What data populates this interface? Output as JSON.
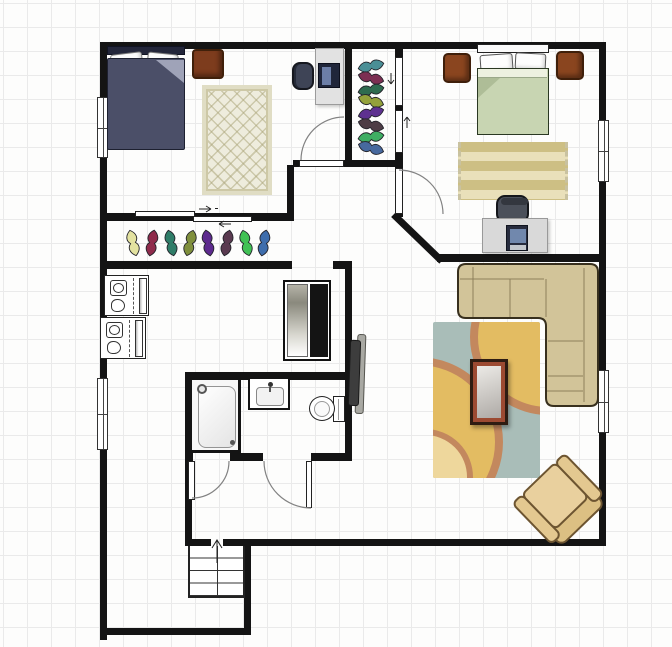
{
  "plan": {
    "width": 672,
    "height": 647,
    "grid_size": 24,
    "palette": {
      "background": "#fdfdfc",
      "grid_line": "#eaeaea",
      "wall": "#141414",
      "door_arc": "#828282",
      "bed1_blanket": "#4b4f68",
      "bed2_blanket": "#c8d5b2",
      "wood_furniture": "#7d3c1d",
      "sofa": "#d2c499",
      "armchair": "#e9d09e",
      "living_rug_base": "#a9bdb8",
      "living_rug_circle": "#e3bc62",
      "living_rug_ring": "#c3885e",
      "bed2_rug_stripe_dark": "#cdbf84",
      "bed2_rug_stripe_light": "#e9e0ba"
    }
  },
  "walls": [
    {
      "name": "wall-exterior-top",
      "rect": [
        100,
        42,
        506,
        7
      ]
    },
    {
      "name": "wall-exterior-left",
      "rect": [
        100,
        42,
        7,
        598
      ]
    },
    {
      "name": "wall-exterior-right",
      "rect": [
        599,
        42,
        7,
        504
      ]
    },
    {
      "name": "wall-bottom-main-a",
      "rect": [
        188,
        539,
        23,
        7
      ]
    },
    {
      "name": "wall-bottom-main-b",
      "rect": [
        223,
        539,
        377,
        7
      ]
    },
    {
      "name": "wall-entry-right",
      "rect": [
        244,
        546,
        7,
        89
      ]
    },
    {
      "name": "wall-entry-bottom",
      "rect": [
        100,
        628,
        151,
        7
      ]
    },
    {
      "name": "wall-bedroom1-south",
      "rect": [
        107,
        213,
        186,
        8
      ]
    },
    {
      "name": "wall-hall-connector",
      "rect": [
        287,
        165,
        7,
        56
      ]
    },
    {
      "name": "wall-hall-north-a",
      "rect": [
        293,
        160,
        6,
        7
      ]
    },
    {
      "name": "wall-hall-north-b",
      "rect": [
        344,
        160,
        54,
        7
      ]
    },
    {
      "name": "wall-closet-left",
      "rect": [
        345,
        42,
        7,
        125
      ]
    },
    {
      "name": "wall-bedroom2-west",
      "rect": [
        395,
        42,
        8,
        175
      ]
    },
    {
      "name": "wall-diagonal",
      "rect": [
        396,
        212,
        67,
        7,
        44
      ],
      "origin": "0 0"
    },
    {
      "name": "wall-bedroom2-south",
      "rect": [
        437,
        254,
        163,
        8
      ]
    },
    {
      "name": "wall-closetstrip-south-a",
      "rect": [
        100,
        261,
        192,
        8
      ]
    },
    {
      "name": "wall-closetstrip-south-b",
      "rect": [
        333,
        261,
        19,
        8
      ]
    },
    {
      "name": "wall-middle-east",
      "rect": [
        345,
        261,
        7,
        200
      ]
    },
    {
      "name": "wall-bath-north",
      "rect": [
        185,
        372,
        167,
        8
      ]
    },
    {
      "name": "wall-bath-west",
      "rect": [
        185,
        372,
        7,
        174
      ]
    },
    {
      "name": "wall-bath-south-a",
      "rect": [
        185,
        453,
        8,
        8
      ]
    },
    {
      "name": "wall-bath-south-b",
      "rect": [
        230,
        453,
        33,
        8
      ]
    },
    {
      "name": "wall-bath-south-c",
      "rect": [
        311,
        453,
        41,
        8
      ]
    }
  ],
  "windows": [
    {
      "name": "window-bedroom1-left",
      "rect": [
        97,
        97,
        11,
        61
      ]
    },
    {
      "name": "window-laundry-left",
      "rect": [
        97,
        378,
        11,
        72
      ]
    },
    {
      "name": "window-bedroom2-right",
      "rect": [
        598,
        120,
        11,
        62
      ]
    },
    {
      "name": "window-living-right",
      "rect": [
        598,
        370,
        11,
        63
      ]
    }
  ],
  "door_leaves": [
    {
      "name": "door-leaf-bedroom1",
      "rect": [
        299,
        160,
        45,
        7
      ]
    },
    {
      "name": "door-leaf-bedroom2",
      "rect": [
        395,
        168,
        8,
        46
      ]
    },
    {
      "name": "door-leaf-bath-left",
      "rect": [
        188,
        461,
        7,
        39
      ]
    },
    {
      "name": "door-leaf-bath-right",
      "rect": [
        306,
        461,
        6,
        47
      ]
    },
    {
      "name": "sliding-door-bedroom1-a",
      "rect": [
        135,
        211,
        60,
        6
      ]
    },
    {
      "name": "sliding-door-bedroom1-b",
      "rect": [
        193,
        216,
        59,
        6
      ]
    },
    {
      "name": "pocket-door-closet-a",
      "rect": [
        395,
        57,
        8,
        49
      ]
    },
    {
      "name": "pocket-door-closet-b",
      "rect": [
        395,
        110,
        8,
        43
      ]
    }
  ],
  "svg": {
    "shirt_path": "M0,-13 C5.5,-9 6.5,-3.5 2.5,0 C6.5,3.5 5.5,9 0,13 C-5.5,9 -6.5,3.5 -2.5,0 C-6.5,-3.5 -5.5,-9 0,-13 Z",
    "sofa_outline": "M 466,264 H 590 Q 598,264 598,272 V 398 Q 598,406 590,406 H 554 Q 546,406 546,398 V 326 Q 546,318 538,318 H 466 Q 458,318 458,310 V 272 Q 458,264 466,264 Z",
    "sofa_seams": "M 460,279 H 544 M 584,268 V 402 M 510,279 V 317 M 546,279 V 317 M 473,267 V 317 M 548,341 H 583 M 548,376 H 583 M 547,391 H 583",
    "arcs": [
      {
        "name": "arc-bedroom1-door",
        "d": "M 301,160 A 43,43 0 0 1 344,117"
      },
      {
        "name": "arc-bedroom2-door",
        "d": "M 399,170 A 44,44 0 0 1 443,214"
      },
      {
        "name": "arc-bath-door-left",
        "d": "M 229,461 A 37,37 0 0 1 192,498"
      },
      {
        "name": "arc-bath-door-right",
        "d": "M 264,461 A 47,47 0 0 0 311,508"
      }
    ],
    "arrows": [
      {
        "name": "stairs-up-arrow",
        "d": "M 217,563 V 541 M 212,548 L 217,540 L 222,548"
      },
      {
        "name": "slider-arrow-upper",
        "d": "M 199,209 H 211 M 211,209 L 206,206 M 211,209 L 206,212 M 215,208.5 h 3"
      },
      {
        "name": "slider-arrow-lower",
        "d": "M 231,224 H 219 M 219,224 L 224,221 M 219,224 L 224,227"
      },
      {
        "name": "pocket-arrow-down",
        "d": "M 391,73 V 84 M 391,84 L 388,80 M 391,84 L 394,80"
      },
      {
        "name": "pocket-arrow-up",
        "d": "M 407,128 V 117 M 407,117 L 404,121 M 407,117 L 410,121"
      }
    ]
  },
  "hanger_rows": [
    {
      "name": "hall-closet-hanger-row",
      "cy": 243,
      "items": [
        {
          "name": "hanger-shirt-yellow",
          "cx": 133,
          "rot": -14,
          "color": "#e3e2a0"
        },
        {
          "name": "hanger-shirt-maroon",
          "cx": 152,
          "rot": 10,
          "color": "#8f2b4b"
        },
        {
          "name": "hanger-shirt-teal",
          "cx": 171,
          "rot": -12,
          "color": "#2f7d68"
        },
        {
          "name": "hanger-shirt-olive",
          "cx": 190,
          "rot": 14,
          "color": "#7f8f3c"
        },
        {
          "name": "hanger-shirt-purple",
          "cx": 208,
          "rot": -10,
          "color": "#5d2a8e"
        },
        {
          "name": "hanger-shirt-plum",
          "cx": 227,
          "rot": 12,
          "color": "#5a3a50"
        },
        {
          "name": "hanger-shirt-green",
          "cx": 246,
          "rot": -14,
          "color": "#41c155"
        },
        {
          "name": "hanger-shirt-blue",
          "cx": 264,
          "rot": 10,
          "color": "#3e6dac"
        }
      ]
    },
    {
      "name": "vertical-closet-hanger-column",
      "cx": 371,
      "items": [
        {
          "name": "closet-shirt-teal",
          "cy": 66,
          "rot": 78,
          "color": "#4a8f96"
        },
        {
          "name": "closet-shirt-maroon",
          "cy": 78,
          "rot": 104,
          "color": "#7c2f52"
        },
        {
          "name": "closet-shirt-darkgreen",
          "cy": 90,
          "rot": 80,
          "color": "#2e6b4f"
        },
        {
          "name": "closet-shirt-olive",
          "cy": 101,
          "rot": 106,
          "color": "#93a13b"
        },
        {
          "name": "closet-shirt-purple",
          "cy": 113,
          "rot": 76,
          "color": "#5e3190"
        },
        {
          "name": "closet-shirt-brown",
          "cy": 125,
          "rot": 104,
          "color": "#4d3c45"
        },
        {
          "name": "closet-shirt-green",
          "cy": 137,
          "rot": 82,
          "color": "#3fae63"
        },
        {
          "name": "closet-shirt-blue",
          "cy": 148,
          "rot": 106,
          "color": "#47699e"
        }
      ]
    }
  ],
  "furniture": {
    "bed1": {
      "headboard": [
        107,
        46,
        78,
        9
      ],
      "pillow_a": [
        111,
        53,
        32,
        21,
        -7
      ],
      "pillow_b": [
        147,
        53,
        31,
        19,
        6
      ],
      "blanket": [
        107,
        58,
        78,
        92
      ],
      "fold": [
        48,
        1,
        28,
        23
      ]
    },
    "dresser1": {
      "rect": [
        192,
        49,
        32,
        30
      ]
    },
    "rug1": {
      "rect": [
        202,
        85,
        70,
        110
      ]
    },
    "desk1": {
      "rect": [
        315,
        48,
        29,
        57
      ]
    },
    "monitor1": {
      "rect": [
        318,
        63,
        22,
        25
      ],
      "screen": [
        3,
        3,
        9,
        18
      ]
    },
    "chair1": {
      "rect": [
        292,
        62,
        22,
        28
      ]
    },
    "washer_a": {
      "rect": [
        104,
        275,
        45,
        41
      ],
      "drum": [
        5,
        4,
        17,
        16
      ],
      "drum_inner": [
        8,
        7,
        11,
        10
      ],
      "clothes": [
        6,
        23,
        14,
        13
      ],
      "divider": [
        28,
        2,
        1,
        36
      ],
      "panel": [
        34,
        2,
        8,
        36
      ]
    },
    "washer_b": {
      "rect": [
        100,
        317,
        46,
        42
      ],
      "drum": [
        5,
        4,
        17,
        16
      ],
      "drum_inner": [
        8,
        7,
        11,
        10
      ],
      "clothes": [
        6,
        23,
        14,
        13
      ],
      "divider": [
        28,
        2,
        1,
        37
      ],
      "panel": [
        34,
        2,
        8,
        37
      ]
    },
    "wardrobe": {
      "rect": [
        283,
        280,
        48,
        81
      ],
      "mirror": [
        2,
        2,
        21,
        73
      ],
      "dark": [
        25,
        2,
        18,
        73
      ]
    },
    "tv_back": {
      "rect": [
        356,
        334,
        9,
        80,
        2
      ]
    },
    "tv_front": {
      "rect": [
        349,
        340,
        11,
        66,
        2
      ]
    },
    "shower": {
      "rect": [
        189,
        377,
        52,
        76
      ],
      "tub": [
        6,
        6,
        38,
        62
      ],
      "head": [
        5,
        4,
        10,
        10
      ],
      "drain": [
        38,
        60,
        5,
        5
      ]
    },
    "sink": {
      "rect": [
        248,
        377,
        42,
        33
      ],
      "basin": [
        6,
        8,
        28,
        19
      ],
      "faucet": [
        18,
        3,
        5,
        5
      ],
      "stem": [
        19,
        8,
        2,
        5
      ]
    },
    "toilet": {
      "tank": [
        333,
        396,
        12,
        26
      ],
      "tank_line": [
        4,
        2,
        1,
        21
      ],
      "bowl": [
        309,
        396,
        26,
        25
      ],
      "seat": [
        4,
        4,
        16,
        16
      ]
    },
    "stairs": {
      "rect": [
        188,
        546,
        57,
        52
      ],
      "mid": [
        27,
        0,
        1,
        50
      ]
    },
    "rug_living": {
      "rect": [
        433,
        322,
        107,
        156
      ],
      "circle1": [
        37,
        -63,
        156,
        156
      ],
      "circle2": [
        -100,
        35,
        170,
        170
      ],
      "circle3": [
        -56,
        107,
        96,
        96
      ]
    },
    "coffee_table": {
      "rect": [
        470,
        359,
        38,
        66
      ],
      "glass": [
        4,
        4,
        24,
        52
      ]
    },
    "armchair": {
      "rect": [
        521,
        461,
        78,
        80,
        -44
      ],
      "back": [
        8,
        54,
        62,
        20
      ],
      "seat": [
        15,
        8,
        48,
        50
      ],
      "arm_l": [
        2,
        8,
        15,
        58
      ],
      "arm_r": [
        61,
        8,
        15,
        58
      ]
    },
    "bed2": {
      "headboard": [
        477,
        44,
        72,
        9
      ],
      "pillow_a": [
        480,
        54,
        33,
        18,
        -4
      ],
      "pillow_b": [
        515,
        53,
        31,
        17,
        3
      ],
      "blanket": [
        477,
        68,
        72,
        67
      ],
      "turndown": [
        0,
        0,
        69,
        9
      ],
      "fold": [
        0,
        9,
        22,
        20
      ]
    },
    "night_l": {
      "rect": [
        443,
        53,
        28,
        30
      ]
    },
    "night_r": {
      "rect": [
        556,
        51,
        28,
        29
      ]
    },
    "rug2": {
      "rect": [
        458,
        142,
        110,
        58
      ]
    },
    "desk2": {
      "rect": [
        482,
        218,
        66,
        35
      ]
    },
    "laptop": {
      "rect": [
        506,
        225,
        22,
        26
      ],
      "screen": [
        3,
        3,
        16,
        14
      ],
      "kb": [
        3,
        19,
        16,
        5
      ]
    },
    "chair2": {
      "rect": [
        496,
        195,
        33,
        28
      ],
      "back": [
        3,
        1,
        27,
        7
      ]
    }
  }
}
